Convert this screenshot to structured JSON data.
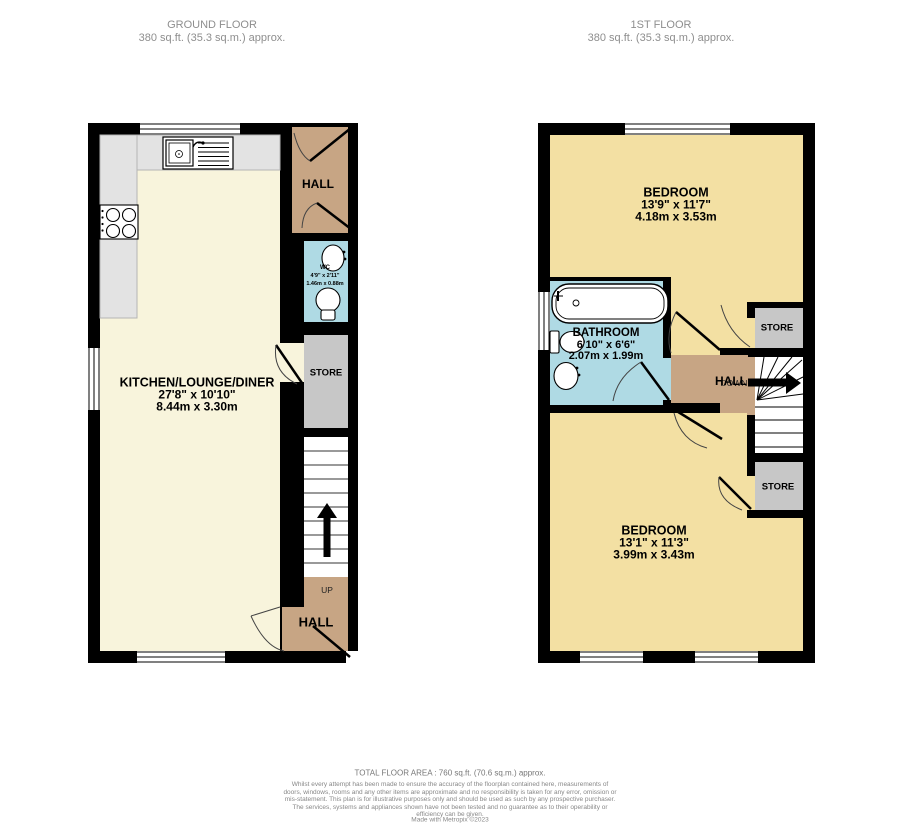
{
  "headers": {
    "ground": {
      "title": "GROUND FLOOR",
      "area": "380 sq.ft. (35.3 sq.m.) approx."
    },
    "first": {
      "title": "1ST FLOOR",
      "area": "380 sq.ft. (35.3 sq.m.) approx."
    }
  },
  "ground_floor": {
    "hall_top_label": "HALL",
    "wc": {
      "name": "WC",
      "imperial": "4'9\" x 2'11\"",
      "metric": "1.46m x 0.88m"
    },
    "store_label": "STORE",
    "kitchen": {
      "name": "KITCHEN/LOUNGE/DINER",
      "imperial": "27'8\"  x 10'10\"",
      "metric": "8.44m  x 3.30m"
    },
    "up_label": "UP",
    "hall_bottom_label": "HALL"
  },
  "first_floor": {
    "bedroom_top": {
      "name": "BEDROOM",
      "imperial": "13'9\"  x 11'7\"",
      "metric": "4.18m  x 3.53m"
    },
    "bathroom": {
      "name": "BATHROOM",
      "imperial": "6'10\"  x 6'6\"",
      "metric": "2.07m  x 1.99m"
    },
    "store_top_label": "STORE",
    "hall_label": "HALL",
    "down_label": "DOWN",
    "store_bottom_label": "STORE",
    "bedroom_bottom": {
      "name": "BEDROOM",
      "imperial": "13'1\"  x 11'3\"",
      "metric": "3.99m  x 3.43m"
    }
  },
  "footer": {
    "total": "TOTAL FLOOR AREA : 760 sq.ft. (70.6 sq.m.) approx.",
    "disclaimer": "Whilst every attempt has been made to ensure the accuracy of the floorplan contained here, measurements of doors, windows, rooms and any other items are approximate and no responsibility is taken for any error, omission or mis-statement. This plan is for illustrative purposes only and should be used as such by any prospective purchaser. The services, systems and appliances shown have not been tested and no guarantee as to their operability or efficiency can be given.",
    "credit": "Made with Metropix ©2023"
  },
  "colors": {
    "wall": "#000000",
    "floor_cream": "#F8F4DC",
    "floor_yellow": "#F3E0A3",
    "floor_tan": "#C7A584",
    "floor_blue": "#AFDAE4",
    "floor_gray": "#C7C7C7",
    "counter_gray": "#E3E3E3"
  }
}
